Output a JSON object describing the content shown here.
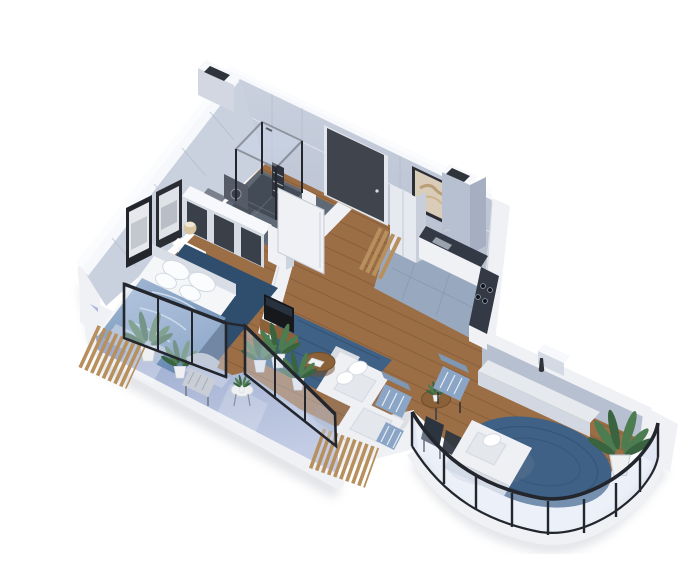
{
  "scene": {
    "type": "3d-isometric-floorplan-render",
    "description": "Axonometric cutaway render of a one-bedroom apartment with wraparound glass balcony",
    "background": "#ffffff"
  },
  "palette": {
    "bg": "#ffffff",
    "wallTop": "#f7f8fb",
    "wallOuter": "#eceef3",
    "wallFace": "#c9d0de",
    "wallFaceDark": "#b7c0d0",
    "wallShade": "#a6afc2",
    "partWhite": "#eff1f5",
    "wood": "#9c6e46",
    "woodDark": "#7e5637",
    "plank": "#4a2f16",
    "bathFloor": "#5f6875",
    "bathDark": "#434b57",
    "kitchenFloor": "#98a8be",
    "balconyFloor": "#a9b8d8",
    "glassTop": "#8ea0c8",
    "glassBottom": "#c3cce4",
    "glassTint": "#cddaee",
    "frameBlack": "#23262c",
    "doorDark": "#3f444d",
    "rug": "#3f6186",
    "rugDark": "#2f4d6d",
    "duvet1": "#a9bdd8",
    "duvet2": "#6488b0",
    "sheet": "#f4f6f8",
    "sofa": "#eef0f4",
    "sofaShade": "#d7dbe2",
    "cushion": "#e4e7ec",
    "stripeBlue": "#8ba5c6",
    "tableWood": "#8a6138",
    "slatWood": "#b8905e",
    "plantG1": "#4d7c50",
    "plantG2": "#3a6340",
    "pot": "#eef0f2",
    "lamp": "#d8c5a0",
    "art": "#d9ccb8",
    "artStroke": "#b99e78",
    "counterTop": "#333a45",
    "steel": "#9aa3ad",
    "shadow": "#9aa1ad",
    "tvBlack": "#16181c",
    "chairGray": "#c9ced6"
  },
  "rooms": [
    {
      "name": "bathroom",
      "floor": "dark-tile",
      "items": [
        "walk-in-shower",
        "toilet",
        "towel-ladder",
        "washer",
        "open-door"
      ]
    },
    {
      "name": "entry-hall",
      "floor": "wood",
      "items": [
        "front-door",
        "tall-cabinet",
        "wood-slat-decor"
      ]
    },
    {
      "name": "kitchen",
      "floor": "blue-gray-tile",
      "items": [
        "l-shaped-counter",
        "cooktop",
        "sink",
        "wall-art",
        "vent-chimney"
      ]
    },
    {
      "name": "bedroom",
      "floor": "wood",
      "items": [
        "double-bed",
        "open-wardrobe",
        "nightstand",
        "table-lamp",
        "wall-art-frames",
        "navy-rug",
        "plants"
      ]
    },
    {
      "name": "living-room",
      "floor": "wood",
      "items": [
        "tv",
        "tv-console",
        "l-shaped-sofa",
        "coffee-table",
        "blue-rug",
        "plants"
      ]
    },
    {
      "name": "lounge-dining",
      "floor": "wood",
      "items": [
        "loveseat",
        "striped-armchairs",
        "dining-chairs",
        "round-dining-table",
        "sideboard",
        "vase",
        "round-blue-rug",
        "tall-plant"
      ]
    },
    {
      "name": "balcony",
      "floor": "glass-blue",
      "items": [
        "wicker-chair",
        "side-table",
        "plants",
        "wood-slat-screens",
        "glass-parapet",
        "curved-black-railing"
      ]
    }
  ]
}
